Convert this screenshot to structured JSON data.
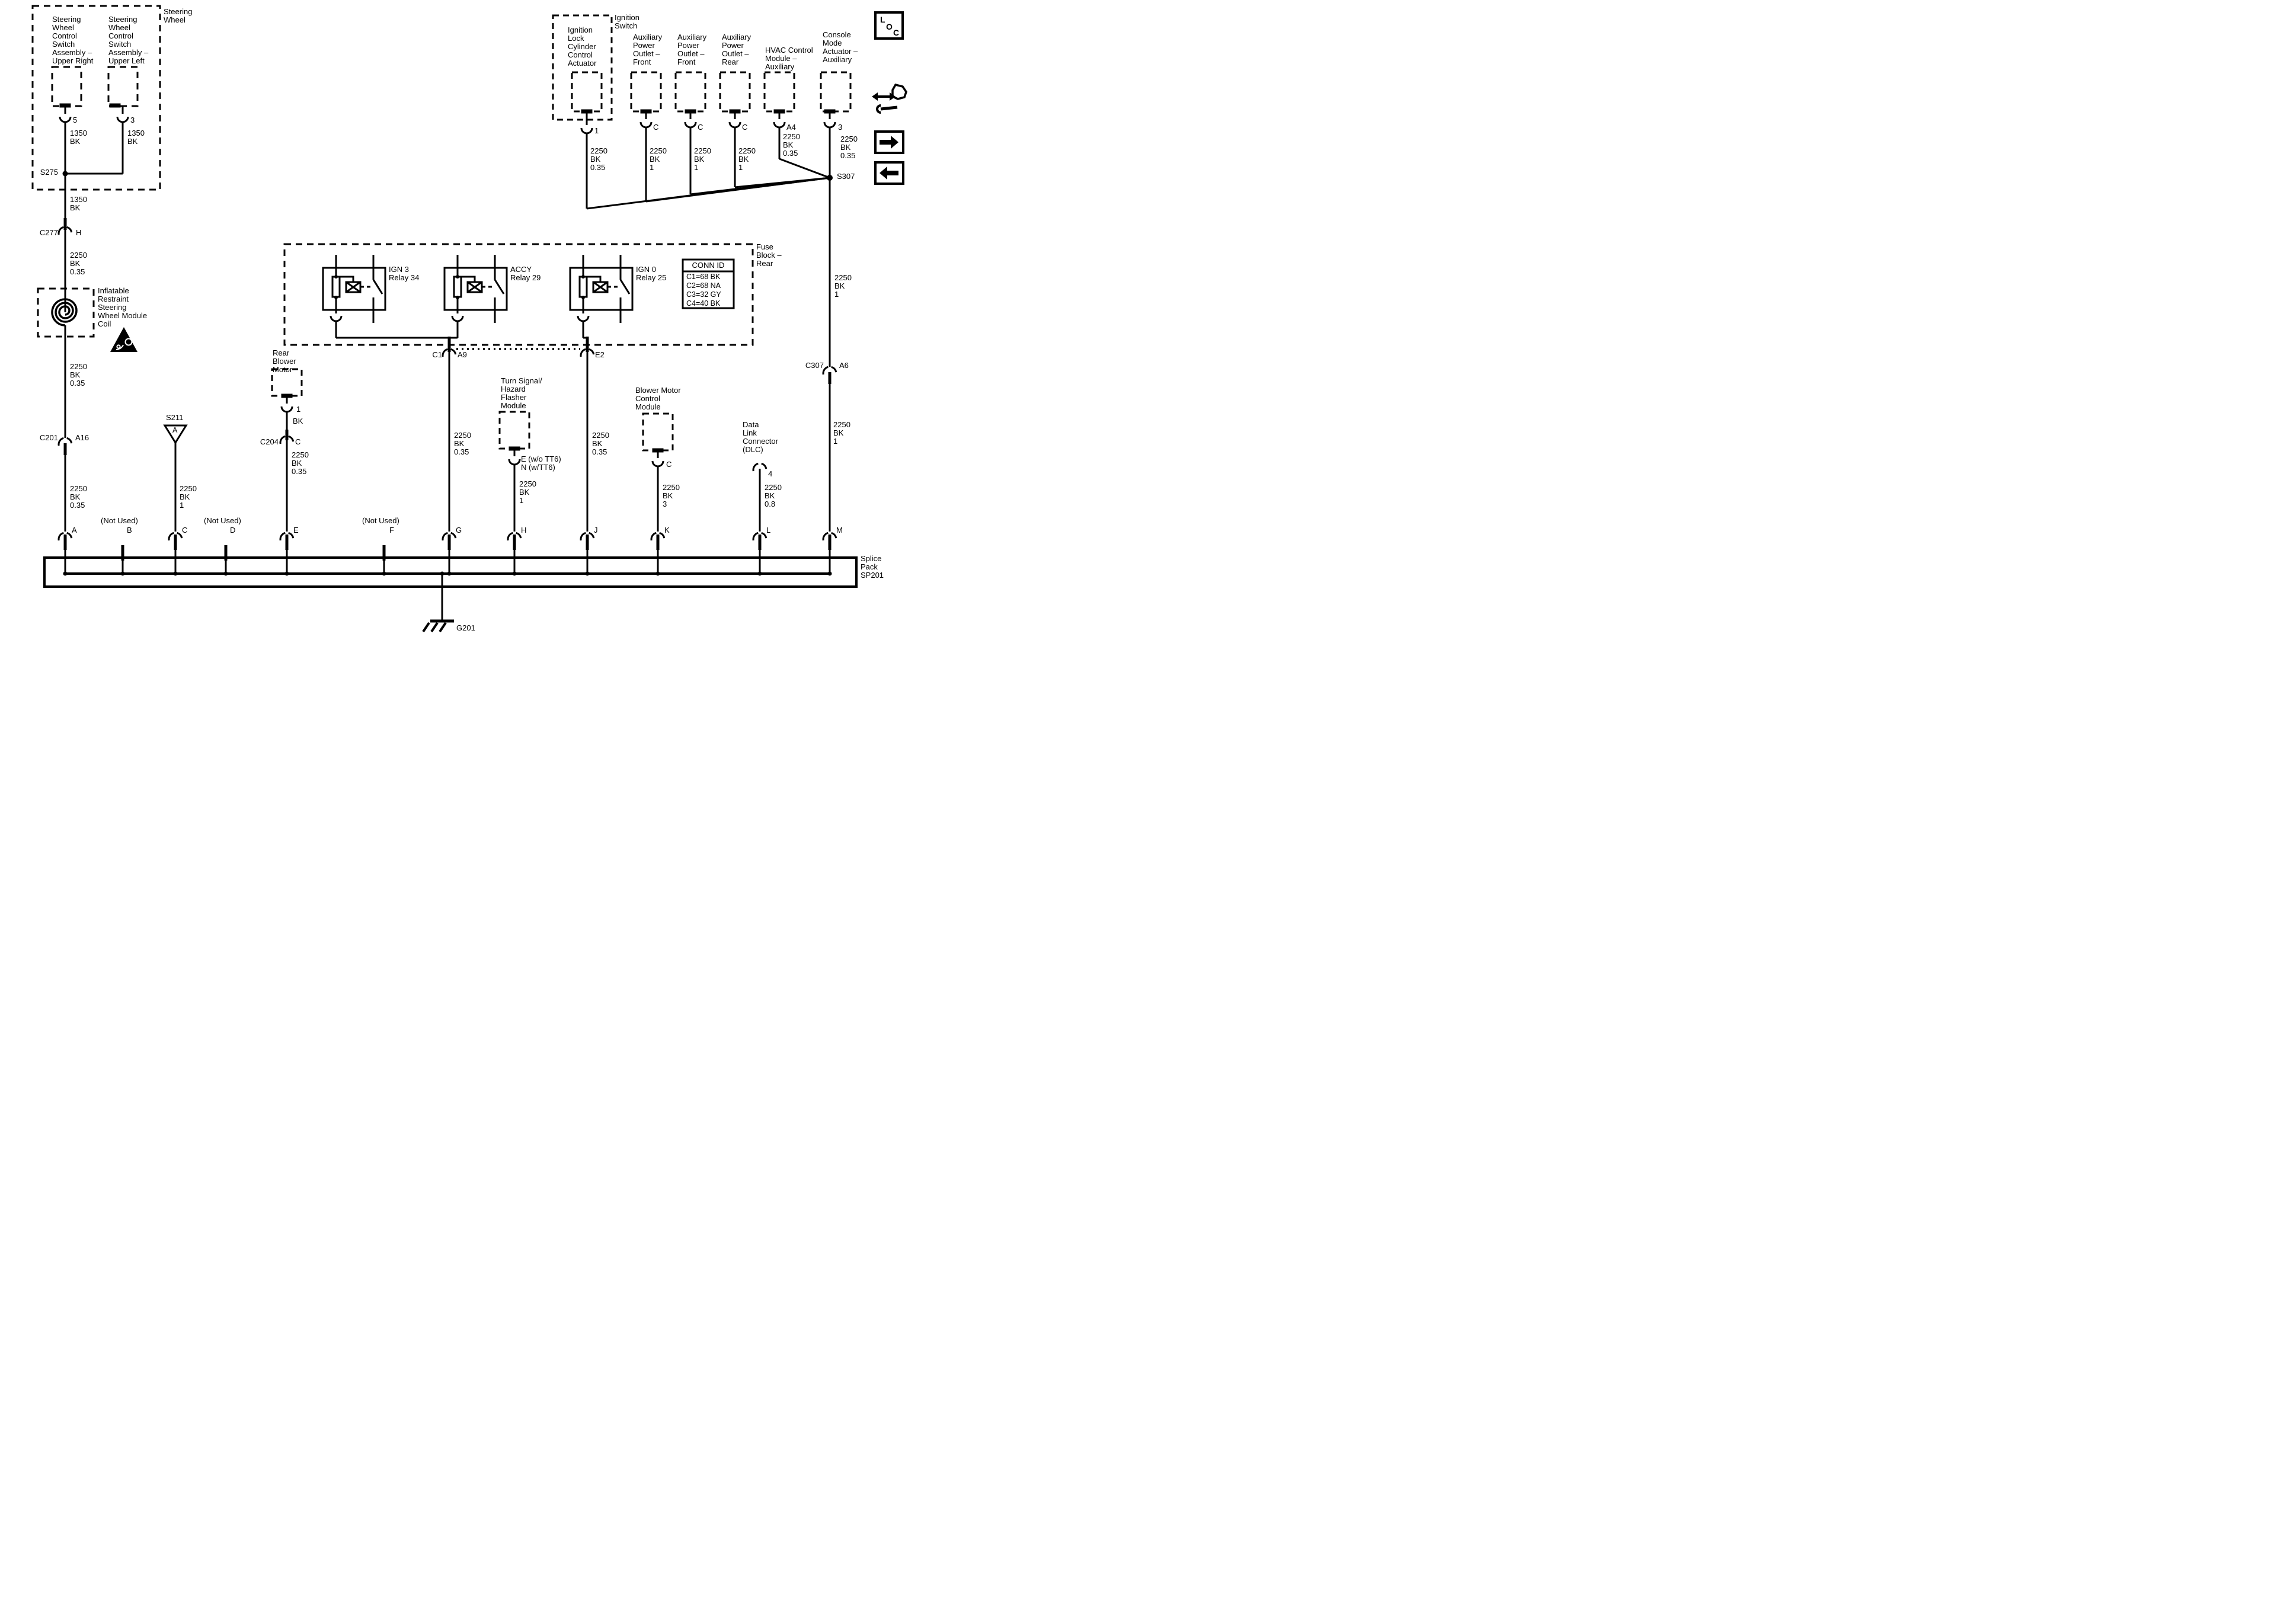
{
  "steering_wheel": {
    "label": "Steering\nWheel",
    "upper_right": {
      "label": "Steering\nWheel\nControl\nSwitch\nAssembly –\nUpper Right",
      "pin": "5",
      "wire": "1350\nBK"
    },
    "upper_left": {
      "label": "Steering\nWheel\nControl\nSwitch\nAssembly –\nUpper Left",
      "pin": "3",
      "wire": "1350\nBK"
    },
    "splice": "S275",
    "wire_out": "1350\nBK"
  },
  "c277": {
    "name": "C277",
    "pin": "H",
    "wire_below": "2250\nBK\n0.35"
  },
  "coil": {
    "label": "Inflatable\nRestraint\nSteering\nWheel Module\nCoil",
    "wire_below": "2250\nBK\n0.35"
  },
  "c201": {
    "name": "C201",
    "pin": "A16",
    "wire_below": "2250\nBK\n0.35"
  },
  "s211": {
    "name": "S211",
    "letter": "A",
    "wire_below": "2250\nBK\n1"
  },
  "rear_blower": {
    "label": "Rear\nBlower\nMotor",
    "pin": "1",
    "wire": "BK",
    "conn": {
      "name": "C204",
      "pin": "C"
    },
    "wire_below": "2250\nBK\n0.35"
  },
  "fuse_block": {
    "label": "Fuse\nBlock –\nRear",
    "relays": [
      {
        "label": "IGN 3\nRelay 34"
      },
      {
        "label": "ACCY\nRelay 29"
      },
      {
        "label": "IGN 0\nRelay 25"
      }
    ],
    "conn_id": {
      "header": "CONN ID",
      "rows": [
        "C1=68 BK",
        "C2=68 NA",
        "C3=32 GY",
        "C4=40 BK"
      ]
    },
    "c1": {
      "name": "C1",
      "pin": "A9",
      "wire_below": "2250\nBK\n0.35"
    },
    "e2": {
      "name": "E2",
      "wire_below": "2250\nBK\n0.35"
    }
  },
  "turn_signal": {
    "label": "Turn Signal/\nHazard\nFlasher\nModule",
    "pins": "E (w/o TT6)\nN (w/TT6)",
    "wire_below": "2250\nBK\n1"
  },
  "blower_control": {
    "label": "Blower Motor\nControl\nModule",
    "pin": "C",
    "wire_below": "2250\nBK\n3"
  },
  "dlc": {
    "label": "Data\nLink\nConnector\n(DLC)",
    "pin": "4",
    "wire_below": "2250\nBK\n0.8"
  },
  "ignition": {
    "switch_label": "Ignition\nSwitch",
    "lock_actuator": {
      "label": "Ignition\nLock\nCylinder\nControl\nActuator",
      "pin": "1",
      "wire": "2250\nBK\n0.35"
    }
  },
  "aux_front_1": {
    "label": "Auxiliary\nPower\nOutlet –\nFront",
    "pin": "C",
    "wire": "2250\nBK\n1"
  },
  "aux_front_2": {
    "label": "Auxiliary\nPower\nOutlet –\nFront",
    "pin": "C",
    "wire": "2250\nBK\n1"
  },
  "aux_rear": {
    "label": "Auxiliary\nPower\nOutlet –\nRear",
    "pin": "C",
    "wire": "2250\nBK\n1"
  },
  "hvac": {
    "label": "HVAC Control\nModule –\nAuxiliary",
    "pin": "A4",
    "wire": "2250\nBK\n0.35"
  },
  "console": {
    "label": "Console\nMode\nActuator –\nAuxiliary",
    "pin": "3",
    "wire": "2250\nBK\n0.35"
  },
  "s307": {
    "name": "S307",
    "wire_below": "2250\nBK\n1"
  },
  "c307": {
    "name": "C307",
    "pin": "A6",
    "wire_below": "2250\nBK\n1"
  },
  "splice_pack": {
    "label": "Splice\nPack\nSP201",
    "not_used": "(Not Used)",
    "terminals": [
      "A",
      "B",
      "C",
      "D",
      "E",
      "F",
      "G",
      "H",
      "J",
      "K",
      "L",
      "M"
    ]
  },
  "ground": {
    "name": "G201"
  },
  "corner": {
    "loc": [
      "L",
      "O",
      "C"
    ]
  }
}
